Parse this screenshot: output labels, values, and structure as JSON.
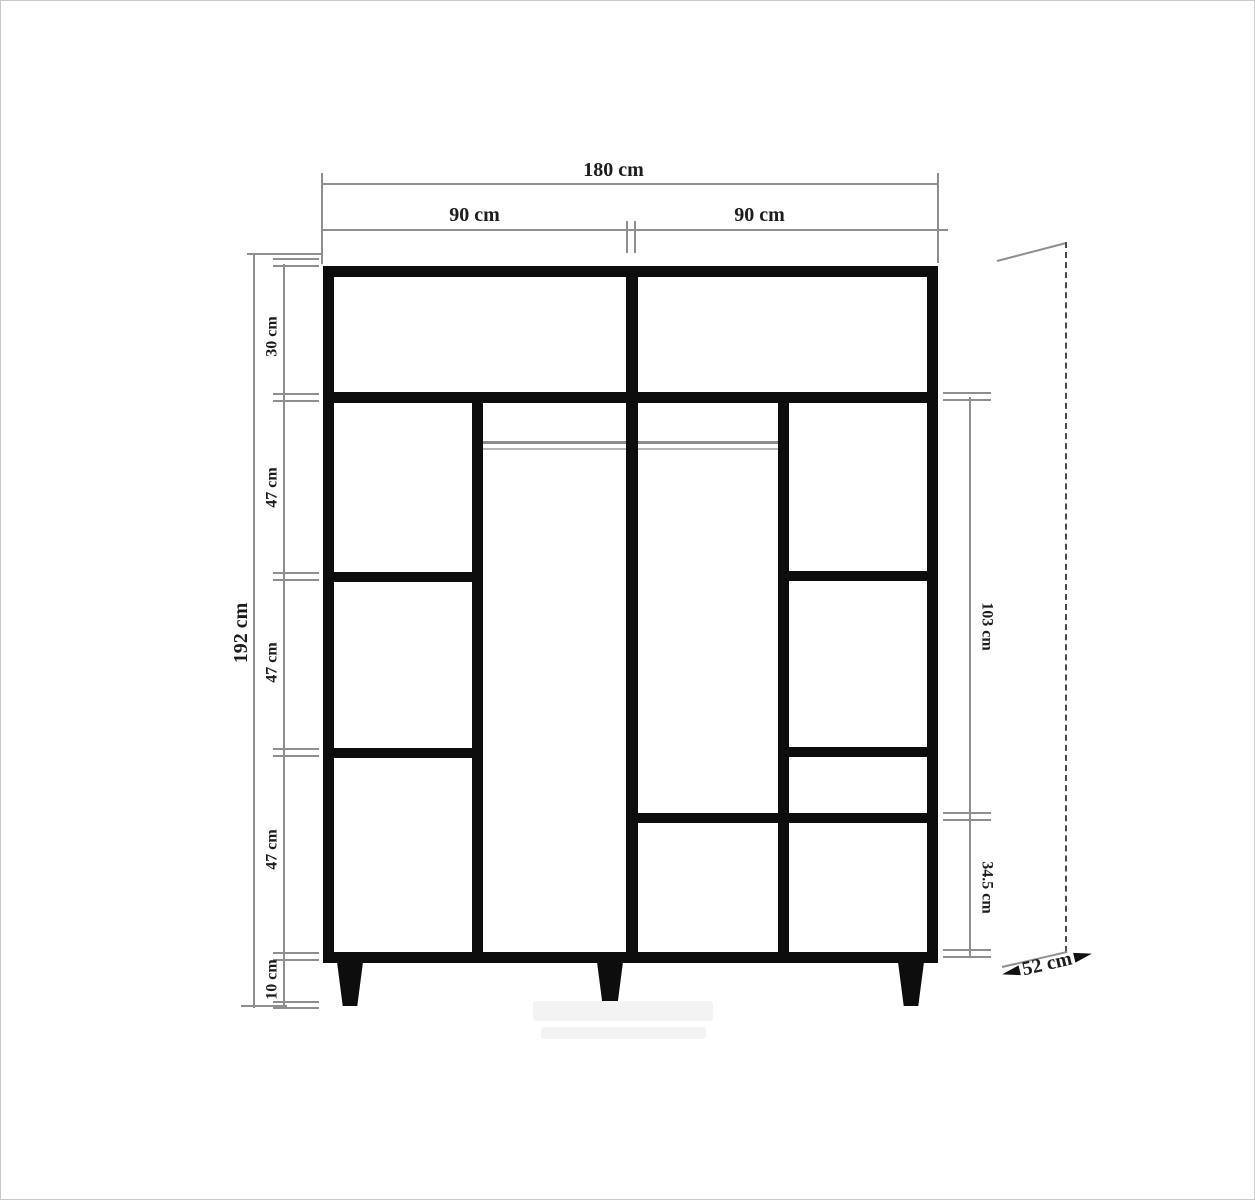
{
  "drawing": {
    "title": "Wardrobe front elevation technical drawing",
    "labels": {
      "total_width": "180 cm",
      "door_left": "90 cm",
      "door_right": "90 cm",
      "total_height": "192 cm",
      "top_section": "30 cm",
      "left_section_1": "47 cm",
      "left_section_2": "47 cm",
      "left_section_3": "47 cm",
      "plinth": "10 cm",
      "hanging_section": "103 cm",
      "bottom_right_section": "34.5 cm",
      "depth": "52 cm"
    },
    "colors": {
      "cabinet_line": "#0d0d0d",
      "dimension_line": "#8f8f8f",
      "rail_gray": "#8d8d8d",
      "background": "#ffffff"
    }
  }
}
